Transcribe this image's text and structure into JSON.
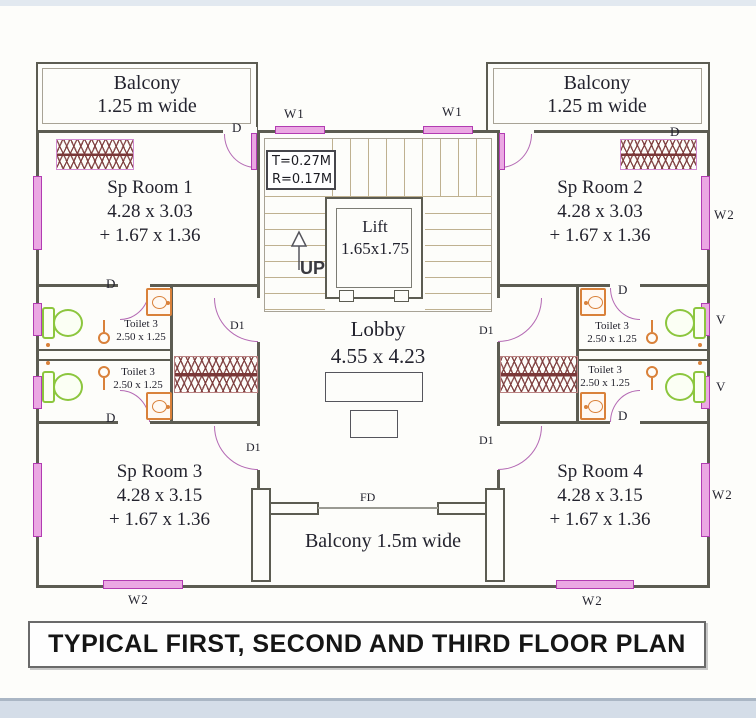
{
  "title": "TYPICAL FIRST, SECOND AND THIRD FLOOR PLAN",
  "balconies": {
    "top_left": {
      "name": "Balcony",
      "width": "1.25 m wide"
    },
    "top_right": {
      "name": "Balcony",
      "width": "1.25 m wide"
    },
    "bottom": {
      "name": "Balcony 1.5m wide"
    }
  },
  "core": {
    "stairs": {
      "tread": "T=0.27M",
      "riser": "R=0.17M",
      "direction": "UP"
    },
    "lift": {
      "name": "Lift",
      "size": "1.65x1.75"
    },
    "lobby": {
      "name": "Lobby",
      "size": "4.55 x 4.23"
    }
  },
  "rooms": {
    "sp_room_1": {
      "name": "Sp Room 1",
      "size": "4.28 x 3.03",
      "extra": "+ 1.67 x 1.36"
    },
    "sp_room_2": {
      "name": "Sp Room 2",
      "size": "4.28 x 3.03",
      "extra": "+ 1.67 x 1.36"
    },
    "sp_room_3": {
      "name": "Sp Room 3",
      "size": "4.28 x 3.15",
      "extra": "+ 1.67 x 1.36"
    },
    "sp_room_4": {
      "name": "Sp Room 4",
      "size": "4.28 x 3.15",
      "extra": "+ 1.67 x 1.36"
    }
  },
  "toilet": {
    "name": "Toilet 3",
    "size": "2.50 x 1.25"
  },
  "tags": {
    "window_w1": "W1",
    "window_w2": "W2",
    "vent": "V",
    "door": "D",
    "door_d1": "D1",
    "door_fd": "FD"
  },
  "colors": {
    "wall": "#5c5c52",
    "window": "#c24cc2",
    "window_fill": "#eba8e3",
    "door_arc": "#b46ab4",
    "wc_fixture": "#8cc63e",
    "basin_fixture": "#d9813a",
    "hatch": "#7a3838",
    "paper": "#fdfdfa"
  }
}
